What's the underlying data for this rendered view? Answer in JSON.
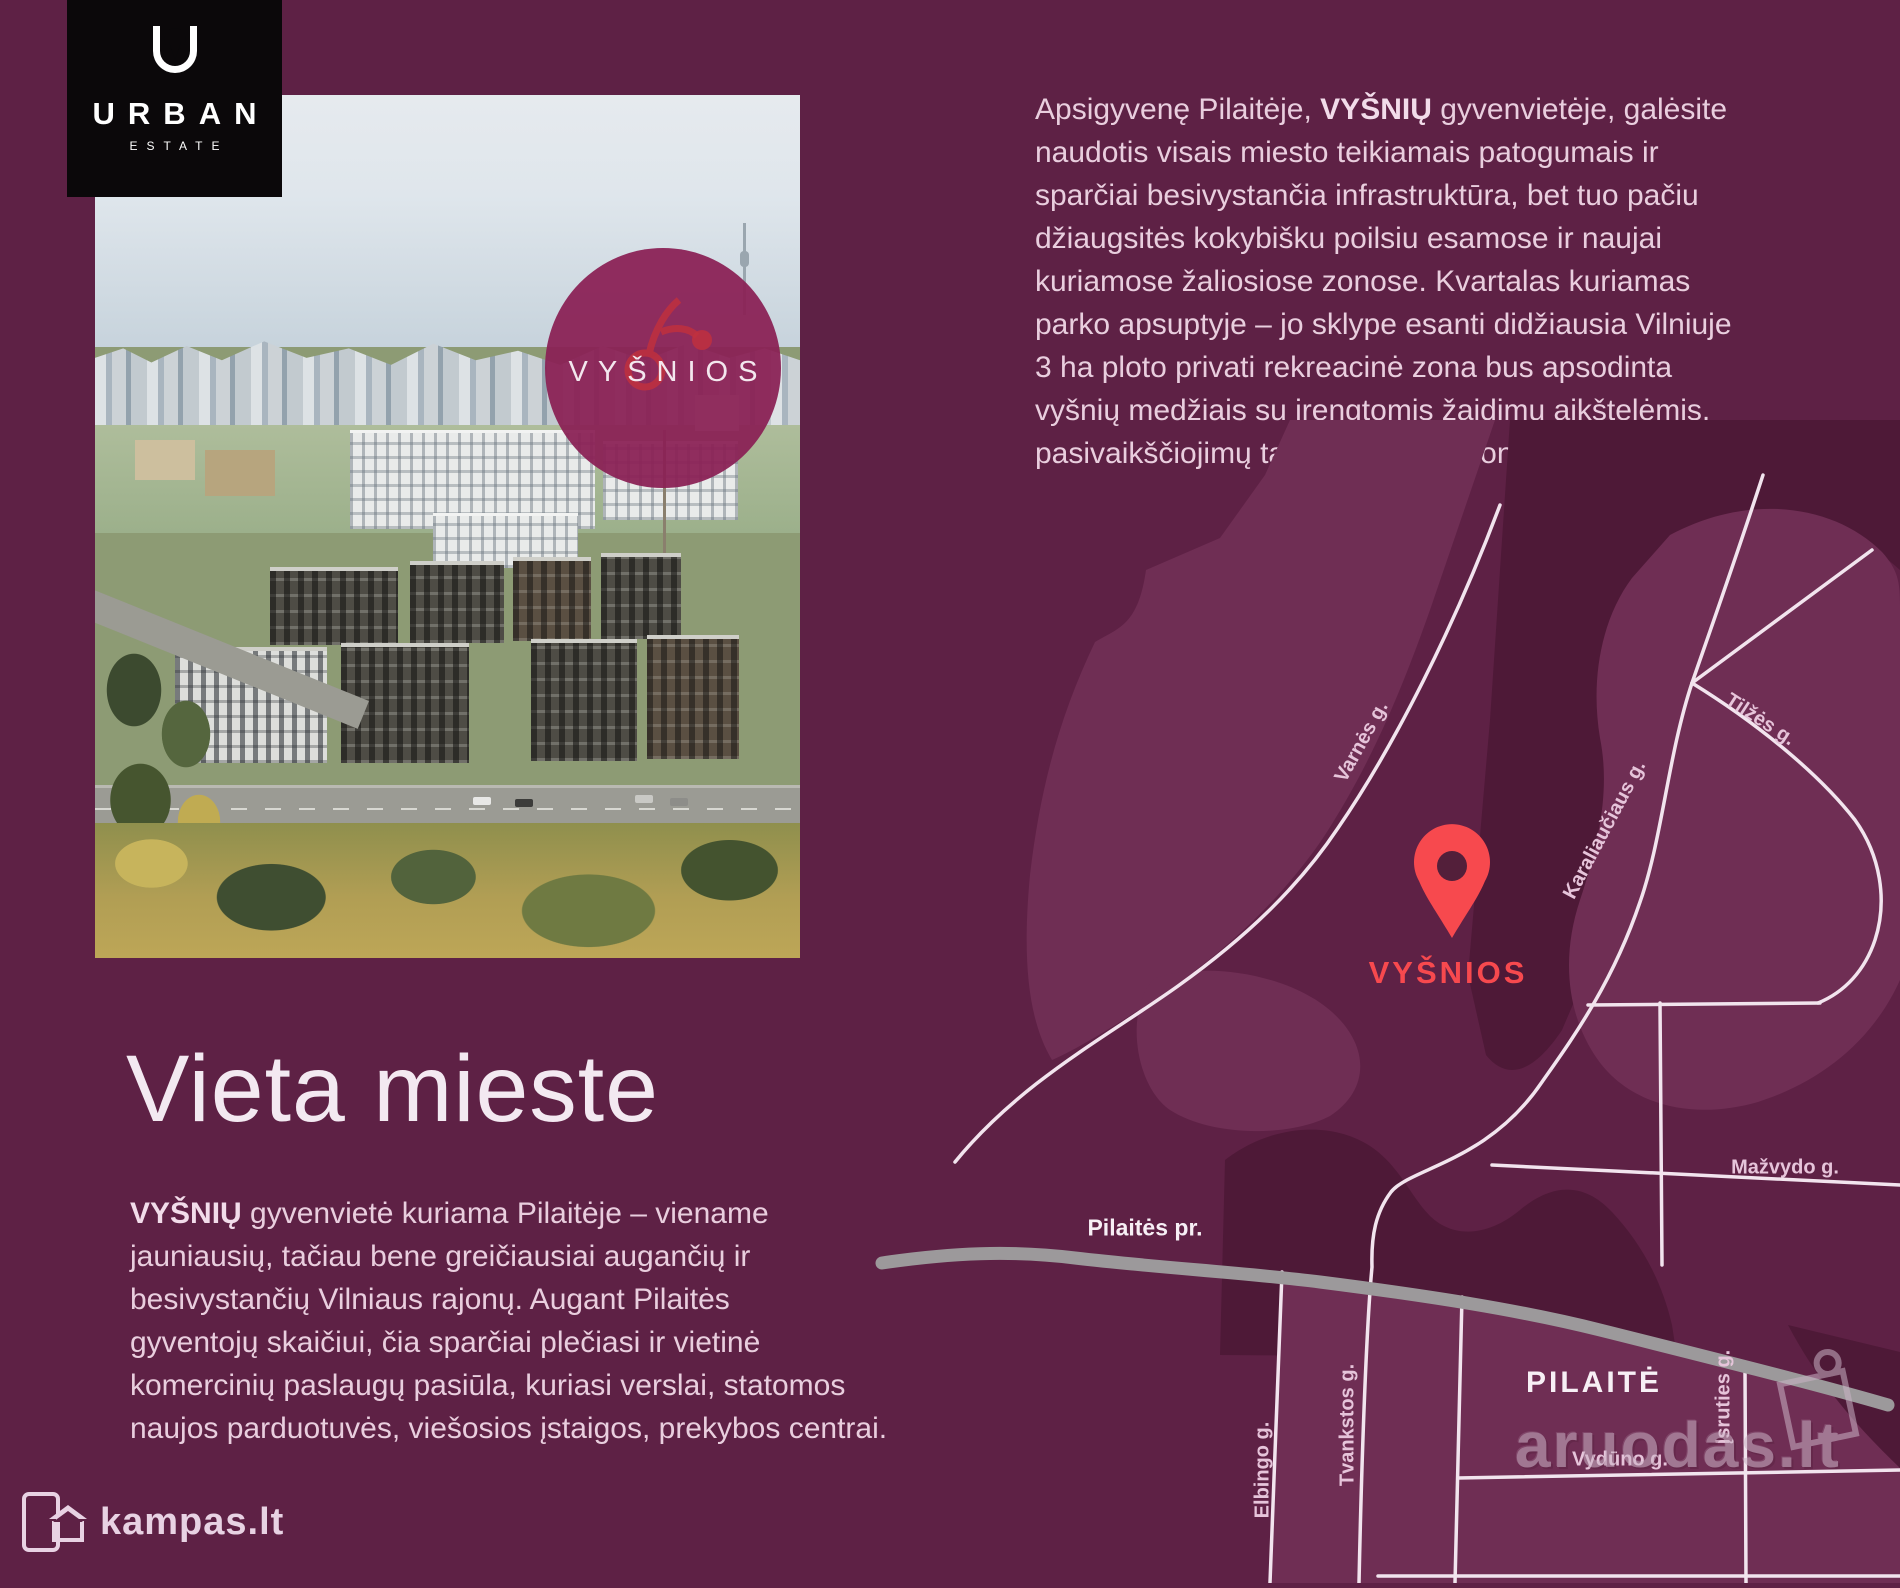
{
  "page": {
    "width": 1900,
    "height": 1583,
    "background": "#5e2145"
  },
  "logo": {
    "icon": "keyhole-u-icon",
    "line1": "URBAN",
    "line2": "ESTATE",
    "background": "#0b080a",
    "color": "#ffffff"
  },
  "photo": {
    "badge_title": "VYŠNIOS"
  },
  "intro_paragraph": {
    "line1_pre": "Apsigyvenę Pilaitėje, ",
    "line1_bold": "VYŠNIŲ",
    "line1_post": " gyvenvietėje, galėsite",
    "lines": [
      "naudotis visais miesto teikiamais patogumais ir",
      "sparčiai besivystančia infrastruktūra, bet tuo pačiu",
      "džiaugsitės kokybišku poilsiu esamose ir naujai",
      "kuriamose žaliosiose zonose. Kvartalas kuriamas",
      "parko apsuptyje – jo sklype esanti didžiausia Vilniuje",
      "3 ha ploto privati rekreacinė zona bus apsodinta",
      "vyšnių medžiais su įrengtomis žaidimų aikštelėmis,",
      "pasivaikščiojimų takais ir poilsio zonomis."
    ]
  },
  "location_section": {
    "heading": "Vieta mieste",
    "line1_bold": "VYŠNIŲ",
    "line1_post": " gyvenvietė kuriama Pilaitėje – viename",
    "lines": [
      "jauniausių, tačiau bene greičiausiai augančių ir",
      "besivystančių Vilniaus rajonų. Augant Pilaitės",
      "gyventojų skaičiui, čia sparčiai plečiasi ir vietinė",
      "komercinių paslaugų pasiūla, kuriasi verslai, statomos",
      "naujos parduotuvės, viešosios įstaigos, prekybos centrai."
    ]
  },
  "map": {
    "pin_label": "VYŠNIOS",
    "district_label": "PILAITĖ",
    "streets": {
      "varnes": "Varnės g.",
      "tilzes": "Tilžės g.",
      "karaliauciaus": "Karaliaučiaus g.",
      "mazvydo": "Mažvydo g.",
      "pilaites_pr": "Pilaitės pr.",
      "elbingo": "Elbingo g.",
      "tvankstos": "Tvankstos g.",
      "isruties": "Įsruties g.",
      "vyduno": "Vydūno g."
    },
    "colors": {
      "pin": "#f7494e",
      "road": "#f2e4ee",
      "main_road": "#9c999b",
      "area_light": "#6f2e54",
      "area_dark": "#4e1937"
    }
  },
  "watermarks": {
    "left": "kampas.lt",
    "right": "aruodas.lt"
  },
  "palette": {
    "background": "#5e2145",
    "accent_red": "#f7494e",
    "body_text": "#e9cede",
    "heading_text": "#f3e9f1",
    "street_label": "#e6c4da",
    "white_label": "#f7eff5"
  }
}
